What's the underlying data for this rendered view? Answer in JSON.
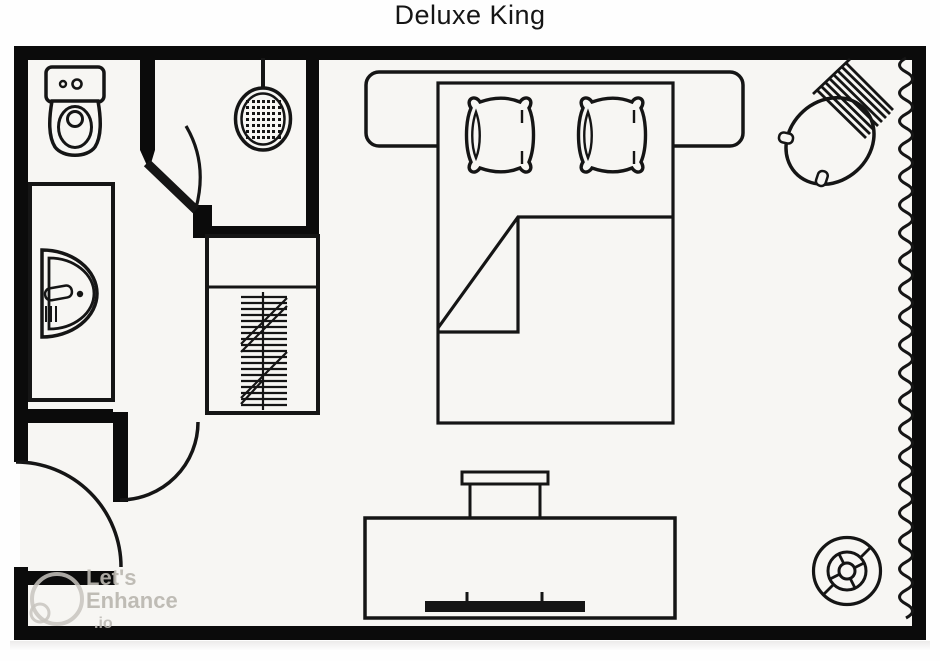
{
  "title": "Deluxe King",
  "watermark": {
    "brand_line1": "Let's",
    "brand_line2": "Enhance",
    "brand_line3": ".io"
  },
  "colors": {
    "ink": "#151515",
    "wall": "#0b0b0b",
    "floor": "#f7f6f3",
    "page": "#fefefe",
    "watermark_gray": "#bab6b0"
  },
  "fixtures": {
    "toilet": "toilet-top-view-icon",
    "shower_drain": "shower-drain-icon",
    "sink_vanity": "sink-vanity-icon",
    "closet": "closet-with-hangers-icon",
    "bed": "king-bed-icon",
    "pillows": "pillow-icon",
    "blanket": "folded-blanket-icon",
    "armchair": "armchair-icon",
    "tv_console": "tv-console-icon",
    "tv": "flat-tv-icon",
    "stool": "round-stool-icon",
    "curtain": "curtain-wave-icon",
    "doors": "door-swing-icon"
  }
}
